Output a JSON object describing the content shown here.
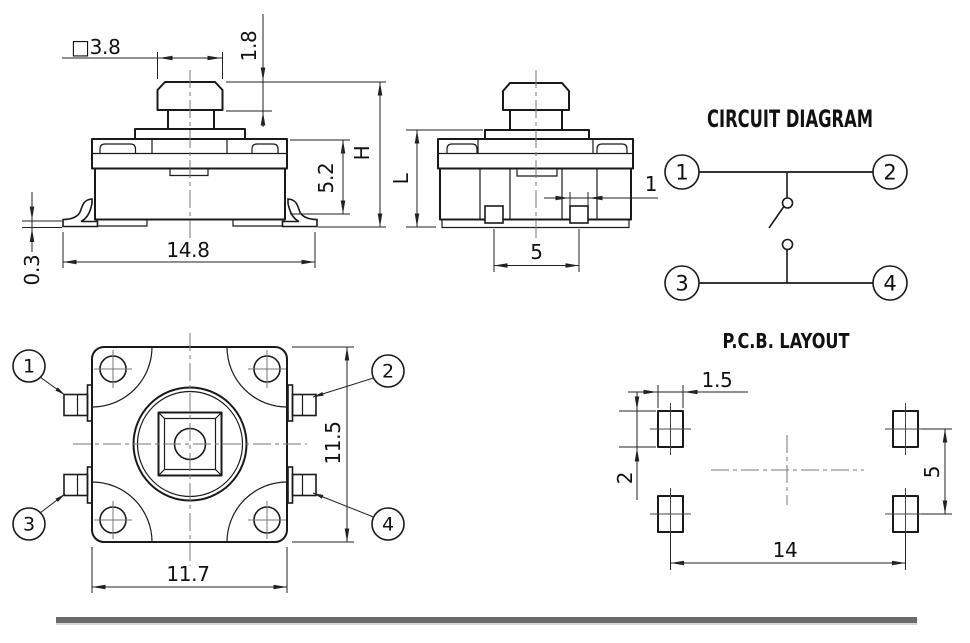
{
  "drawing": {
    "front_view": {
      "button_width": "□3.8",
      "button_height": "1.8",
      "total_height": "H",
      "body_height": "5.2",
      "lead_span": "14.8",
      "lead_standoff": "0.3"
    },
    "side_view": {
      "height": "L",
      "pin_width": "1",
      "pin_pitch": "5"
    },
    "circuit_diagram": {
      "title": "CIRCUIT DIAGRAM",
      "terminals": [
        "1",
        "2",
        "3",
        "4"
      ]
    },
    "top_view": {
      "terminals": [
        "1",
        "2",
        "3",
        "4"
      ],
      "body_width": "11.7",
      "body_height": "11.5"
    },
    "pcb_layout": {
      "title": "P.C.B. LAYOUT",
      "pad_width": "1.5",
      "pad_height": "2",
      "pad_row_pitch": "5",
      "pad_col_pitch": "14"
    },
    "colors": {
      "line": "#1a1a1a",
      "dimension": "#222222",
      "centerline": "#777777",
      "footer_bar": "#6a6a6a",
      "background": "#ffffff"
    }
  }
}
